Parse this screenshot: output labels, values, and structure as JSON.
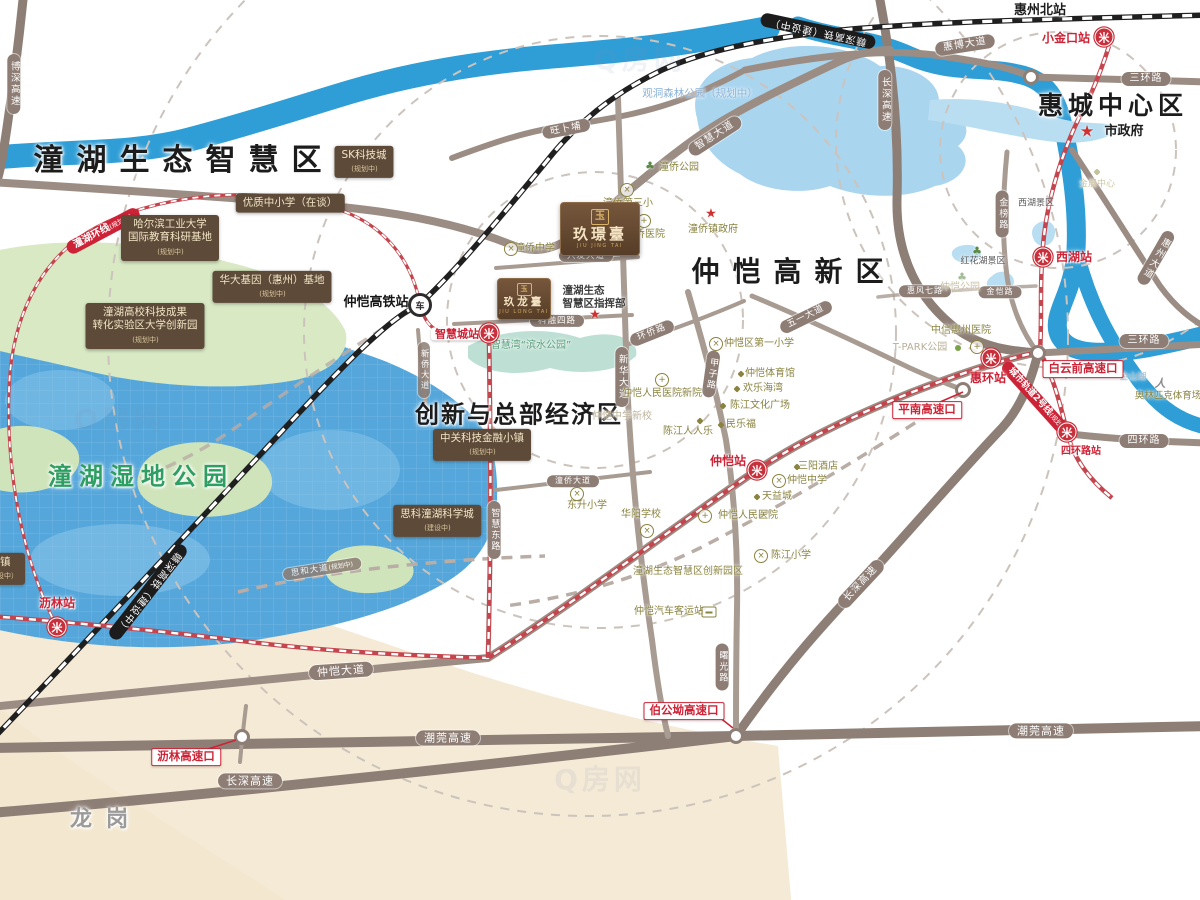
{
  "map": {
    "areas": [
      {
        "t": "潼湖生态智慧区",
        "x": 184,
        "y": 161,
        "fs": 30,
        "ls": 13
      },
      {
        "t": "仲恺高新区",
        "x": 794,
        "y": 272,
        "fs": 28,
        "ls": 13
      },
      {
        "t": "惠城中心区",
        "x": 1113,
        "y": 106,
        "fs": 25,
        "ls": 5
      },
      {
        "t": "创新与总部经济区",
        "x": 519,
        "y": 415,
        "fs": 24,
        "ls": 2
      },
      {
        "t": "潼湖湿地公园",
        "x": 141,
        "y": 477,
        "fs": 24,
        "ls": 7,
        "c": "#2f9e62"
      },
      {
        "t": "龙岗",
        "x": 106,
        "y": 820,
        "fs": 22,
        "ls": 14,
        "c": "#9a9a9a"
      },
      {
        "t": "惠州北站",
        "x": 1040,
        "y": 11,
        "fs": 13
      },
      {
        "t": "市政府",
        "x": 1124,
        "y": 132,
        "fs": 13
      }
    ],
    "stations": [
      {
        "t": "仲恺高铁站",
        "x": 376,
        "y": 303,
        "fs": 13,
        "cls": "black"
      },
      {
        "t": "智慧城站",
        "x": 457,
        "y": 334,
        "fs": 11,
        "cls": "boxed"
      },
      {
        "t": "小金口站",
        "x": 1066,
        "y": 38
      },
      {
        "t": "西湖站",
        "x": 1074,
        "y": 257
      },
      {
        "t": "惠环站",
        "x": 988,
        "y": 378
      },
      {
        "t": "四环路站",
        "x": 1081,
        "y": 452,
        "fs": 10
      },
      {
        "t": "仲恺站",
        "x": 728,
        "y": 461
      },
      {
        "t": "沥林站",
        "x": 57,
        "y": 603
      }
    ],
    "roadPills": [
      {
        "t": "博深高速",
        "x": 14,
        "y": 84,
        "v": true,
        "fs": 9.5
      },
      {
        "t": "长深高速",
        "x": 885,
        "y": 100,
        "v": true,
        "fs": 9.5
      },
      {
        "t": "惠博大道",
        "x": 965,
        "y": 45,
        "rot": -9
      },
      {
        "t": "三环路",
        "x": 1146,
        "y": 79
      },
      {
        "t": "三环路",
        "x": 1144,
        "y": 341
      },
      {
        "t": "四环路",
        "x": 1144,
        "y": 441
      },
      {
        "t": "惠州大道",
        "x": 1156,
        "y": 258,
        "v": true,
        "rot": 30,
        "fs": 9.5
      },
      {
        "t": "金榜路",
        "x": 1002,
        "y": 214,
        "v": true,
        "fs": 9
      },
      {
        "t": "智慧大道",
        "x": 715,
        "y": 136,
        "rot": -33
      },
      {
        "t": "旺卜埔",
        "x": 566,
        "y": 129,
        "rot": -11,
        "fs": 9.5
      },
      {
        "t": "兴发大道",
        "x": 586,
        "y": 256,
        "fs": 8.5
      },
      {
        "t": "科融四路",
        "x": 557,
        "y": 321,
        "fs": 8.5
      },
      {
        "t": "环侨路",
        "x": 652,
        "y": 333,
        "rot": -22,
        "fs": 9
      },
      {
        "t": "新华大道",
        "x": 622,
        "y": 377,
        "v": true,
        "fs": 9.5
      },
      {
        "t": "甲子路",
        "x": 711,
        "y": 374,
        "v": true,
        "rot": 8,
        "fs": 9
      },
      {
        "t": "五一大道",
        "x": 806,
        "y": 317,
        "rot": -26,
        "fs": 9
      },
      {
        "t": "惠风七路",
        "x": 925,
        "y": 291,
        "fs": 8
      },
      {
        "t": "金恺路",
        "x": 1000,
        "y": 292,
        "fs": 8
      },
      {
        "t": "仲恺大道",
        "x": 341,
        "y": 671,
        "rot": -4,
        "fs": 11
      },
      {
        "t": "潮莞高速",
        "x": 448,
        "y": 738,
        "fs": 11
      },
      {
        "t": "潮莞高速",
        "x": 1041,
        "y": 731,
        "fs": 11
      },
      {
        "t": "长深高速",
        "x": 250,
        "y": 781,
        "fs": 11
      },
      {
        "t": "长深高速",
        "x": 861,
        "y": 584,
        "rot": -47,
        "fs": 10
      },
      {
        "t": "曙光路",
        "x": 722,
        "y": 667,
        "v": true,
        "fs": 9
      },
      {
        "t": "智慧东路",
        "x": 494,
        "y": 530,
        "v": true,
        "fs": 9
      },
      {
        "t": "新侨大道",
        "x": 424,
        "y": 370,
        "v": true,
        "fs": 8.5,
        "op": 0.85
      },
      {
        "t": "潼侨大道",
        "x": 573,
        "y": 481,
        "fs": 8
      },
      {
        "t": "思和大道",
        "sub": "(规划中)",
        "x": 322,
        "y": 569,
        "rot": -9,
        "fs": 8.5,
        "op": 0.85
      }
    ],
    "railPills": [
      {
        "t": "赣深高铁（建设中）",
        "x": 818,
        "y": 31,
        "rot": 192
      },
      {
        "t": "赣深高铁（建设中）",
        "x": 148,
        "y": 592,
        "rot": 128
      }
    ],
    "redPills": [
      {
        "t": "潼湖环线",
        "sub": "(规划中)",
        "x": 103,
        "y": 231,
        "rot": -28
      },
      {
        "t": "城市轨道2号线",
        "sub": "(规划中)",
        "x": 1038,
        "y": 401,
        "rot": 48,
        "fs": 9
      }
    ],
    "redBadges": [
      {
        "t": "白云前高速口",
        "x": 1083,
        "y": 369
      },
      {
        "t": "平南高速口",
        "x": 927,
        "y": 410
      },
      {
        "t": "伯公坳高速口",
        "x": 684,
        "y": 711
      },
      {
        "t": "沥林高速口",
        "x": 186,
        "y": 757
      }
    ],
    "brownBoxes": [
      {
        "lines": [
          "SK科技城"
        ],
        "sub": "(规划中)",
        "x": 364,
        "y": 162
      },
      {
        "lines": [
          "优质中小学（在谈）"
        ],
        "x": 290,
        "y": 203
      },
      {
        "lines": [
          "哈尔滨工业大学",
          "国际教育科研基地"
        ],
        "sub": "(规划中)",
        "x": 170,
        "y": 238
      },
      {
        "lines": [
          "华大基因（惠州）基地"
        ],
        "sub": "(规划中)",
        "x": 272,
        "y": 287
      },
      {
        "lines": [
          "潼湖高校科技成果",
          "转化实验区大学创新园"
        ],
        "sub": "(规划中)",
        "x": 145,
        "y": 326
      },
      {
        "lines": [
          "中关科技金融小镇"
        ],
        "sub": "(规划中)",
        "x": 482,
        "y": 445
      },
      {
        "lines": [
          "思科潼湖科学城"
        ],
        "sub": "(建设中)",
        "x": 437,
        "y": 521
      },
      {
        "lines": [
          "小镇"
        ],
        "sub": "（建设中）",
        "x": 0,
        "y": 569
      }
    ],
    "pois": [
      {
        "t": "观洞森林公园",
        "sub": "（规划中）",
        "x": 700,
        "y": 94,
        "c": "#8cb3d6",
        "fs": 10.5
      },
      {
        "t": "潼侨公园",
        "x": 679,
        "y": 168
      },
      {
        "t": "潼侨第三小",
        "x": 628,
        "y": 204
      },
      {
        "t": "潼侨医院",
        "x": 645,
        "y": 235
      },
      {
        "t": "潼侨镇政府",
        "x": 713,
        "y": 230
      },
      {
        "t": "潼侨中学",
        "x": 535,
        "y": 249
      },
      {
        "lines": [
          "潼湖生态",
          "智慧区指挥部"
        ],
        "x": 594,
        "y": 297,
        "c": "#3d3d3d",
        "fs": 10.5,
        "cls": "bold"
      },
      {
        "t": "智慧湾“滨水公园”",
        "x": 531,
        "y": 346,
        "c": "#5a9e7c"
      },
      {
        "t": "仲恺区第一小学",
        "x": 759,
        "y": 344
      },
      {
        "t": "仲恺体育馆",
        "x": 770,
        "y": 374
      },
      {
        "t": "欢乐海湾",
        "x": 763,
        "y": 389
      },
      {
        "t": "陈江文化广场",
        "x": 760,
        "y": 406
      },
      {
        "t": "陈江人人乐",
        "x": 688,
        "y": 432
      },
      {
        "t": "民乐福",
        "x": 741,
        "y": 425
      },
      {
        "t": "仲恺人民医院新院",
        "x": 662,
        "y": 394
      },
      {
        "t": "仲恺中学新校",
        "x": 622,
        "y": 417,
        "c": "#bdb49c"
      },
      {
        "t": "三阳酒店",
        "x": 818,
        "y": 467
      },
      {
        "t": "仲恺中学",
        "x": 807,
        "y": 481
      },
      {
        "t": "天益城",
        "x": 777,
        "y": 497
      },
      {
        "t": "仲恺人民医院",
        "x": 748,
        "y": 516
      },
      {
        "t": "华阳学校",
        "x": 641,
        "y": 515
      },
      {
        "t": "东升小学",
        "x": 587,
        "y": 506
      },
      {
        "t": "陈江小学",
        "x": 791,
        "y": 556
      },
      {
        "t": "潼湖生态智慧区创新园区",
        "x": 688,
        "y": 572
      },
      {
        "t": "仲恺汽车客运站",
        "x": 669,
        "y": 612
      },
      {
        "t": "中信惠州医院",
        "x": 961,
        "y": 331
      },
      {
        "t": "T-PARK公园",
        "x": 920,
        "y": 348,
        "c": "#b9ae96"
      },
      {
        "t": "仲恺公园",
        "x": 960,
        "y": 288,
        "c": "#c8bfa2"
      },
      {
        "t": "红花湖景区",
        "x": 983,
        "y": 262,
        "c": "#5a5a5a",
        "fs": 9
      },
      {
        "t": "西湖景区",
        "x": 1036,
        "y": 204,
        "c": "#5a5a5a",
        "fs": 9
      },
      {
        "t": "金山湖",
        "x": 1133,
        "y": 378,
        "c": "#a8bac8",
        "fs": 9
      },
      {
        "t": "金展中心",
        "x": 1097,
        "y": 185,
        "c": "#cfc6a4",
        "fs": 9
      },
      {
        "t": "奥林匹克体育场",
        "x": 1168,
        "y": 396,
        "fs": 9.5
      }
    ],
    "projects": [
      {
        "seal": "玉",
        "name": "玖璟臺",
        "en": "JIU JING TAI",
        "x": 600,
        "y": 229,
        "w": 78,
        "h": 52,
        "nfs": 15,
        "sfs": 10
      },
      {
        "seal": "玉",
        "name": "玖龙臺",
        "en": "JIU LONG TAI",
        "x": 524,
        "y": 299,
        "w": 52,
        "h": 40,
        "nfs": 10.5,
        "sfs": 7
      }
    ],
    "icons": [
      {
        "k": "metro",
        "x": 1104,
        "y": 37
      },
      {
        "k": "metro",
        "x": 1043,
        "y": 257
      },
      {
        "k": "metro",
        "x": 991,
        "y": 358
      },
      {
        "k": "metro",
        "x": 1067,
        "y": 432
      },
      {
        "k": "metro",
        "x": 757,
        "y": 470
      },
      {
        "k": "metro",
        "x": 489,
        "y": 333
      },
      {
        "k": "metro",
        "x": 57,
        "y": 627
      },
      {
        "k": "rail",
        "x": 420,
        "y": 305
      },
      {
        "k": "star",
        "x": 711,
        "y": 214
      },
      {
        "k": "star",
        "x": 595,
        "y": 315
      },
      {
        "k": "star big",
        "x": 1087,
        "y": 131
      },
      {
        "k": "school",
        "x": 627,
        "y": 190
      },
      {
        "k": "school",
        "x": 511,
        "y": 249
      },
      {
        "k": "school",
        "x": 716,
        "y": 344
      },
      {
        "k": "school",
        "x": 779,
        "y": 481
      },
      {
        "k": "school",
        "x": 647,
        "y": 531
      },
      {
        "k": "school",
        "x": 577,
        "y": 494
      },
      {
        "k": "school",
        "x": 761,
        "y": 556
      },
      {
        "k": "hosp",
        "x": 644,
        "y": 221
      },
      {
        "k": "hosp",
        "x": 662,
        "y": 380
      },
      {
        "k": "hosp",
        "x": 705,
        "y": 516
      },
      {
        "k": "hosp",
        "x": 977,
        "y": 347
      },
      {
        "k": "dot",
        "x": 741,
        "y": 374
      },
      {
        "k": "dot",
        "x": 737,
        "y": 389
      },
      {
        "k": "dot",
        "x": 723,
        "y": 406
      },
      {
        "k": "dot",
        "x": 700,
        "y": 421
      },
      {
        "k": "dot",
        "x": 721,
        "y": 425
      },
      {
        "k": "dot",
        "x": 797,
        "y": 467
      },
      {
        "k": "dot",
        "x": 757,
        "y": 497
      },
      {
        "k": "dot faint",
        "x": 1097,
        "y": 172
      },
      {
        "k": "dotg",
        "x": 958,
        "y": 348
      },
      {
        "k": "tree",
        "x": 650,
        "y": 166
      },
      {
        "k": "tree",
        "x": 977,
        "y": 251
      },
      {
        "k": "tree faint",
        "x": 962,
        "y": 277
      },
      {
        "k": "bus",
        "x": 709,
        "y": 612
      },
      {
        "k": "runner",
        "x": 1160,
        "y": 383
      }
    ],
    "watermarks": [
      {
        "t": "Q房网",
        "x": 640,
        "y": 60
      },
      {
        "t": "Q房网",
        "x": 120,
        "y": 420
      },
      {
        "t": "Q房网",
        "x": 600,
        "y": 780
      }
    ]
  }
}
